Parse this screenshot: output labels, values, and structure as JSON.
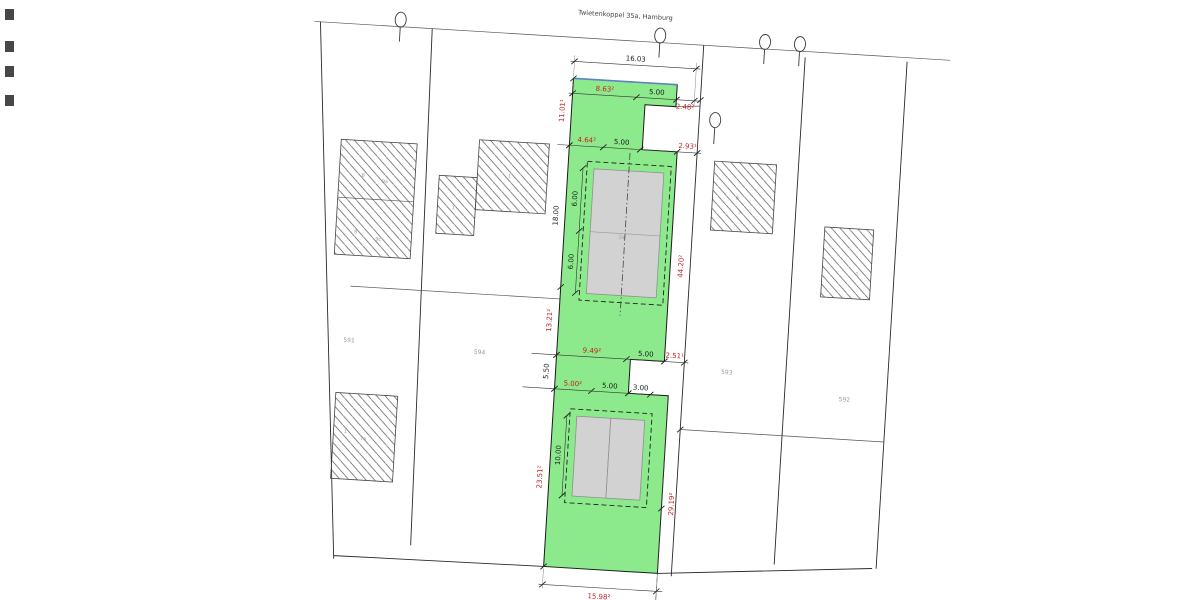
{
  "colors": {
    "parcel_highlight": "#8cea8c",
    "building_fill": "#d2d2d2",
    "dimension_red": "#c22222",
    "boundary_line": "#2a2a2a",
    "street_edge_blue": "#5b84c4"
  },
  "street": {
    "label": "Twietenkoppel 35a, Hamburg"
  },
  "parcels": {
    "p591": "591",
    "p594": "594",
    "p593": "593",
    "p592": "592"
  },
  "dimensions": {
    "top_total": "16.03",
    "row1_a": "8.63²",
    "row1_b": "5.00",
    "row1_c": "2.48²",
    "row2_a": "4.64²",
    "row2_b": "5.00",
    "row2_c": "2.93¹",
    "row3_a": "9.49²",
    "row3_b": "5.00",
    "row3_c": "2.51¹",
    "row4_a": "5.00²",
    "row4_b": "5.00",
    "row4_c": "3.00",
    "left_1": "11.01¹",
    "left_2": "18.00",
    "left_3": "13.21²",
    "left_4": "5.50",
    "left_5": "23.51²",
    "right_1": "44.20²",
    "right_2": "29.19²",
    "bottom_total": "15.98²",
    "bldg_top_1": "6.00",
    "bldg_top_2": "6.00",
    "bldg_bottom_1": "10.00"
  },
  "labels": {
    "main_building": "2a",
    "nbA_top_1": "8",
    "nbA_top_2": "9a",
    "nbA_bot_1": "8",
    "nbA_bot_2": "9c",
    "nbB": "1",
    "nbC": "1",
    "nbD_1": "6",
    "nbD_2": "3",
    "nbE": "2",
    "nbF_1": "1",
    "nbF_2": "7a"
  }
}
